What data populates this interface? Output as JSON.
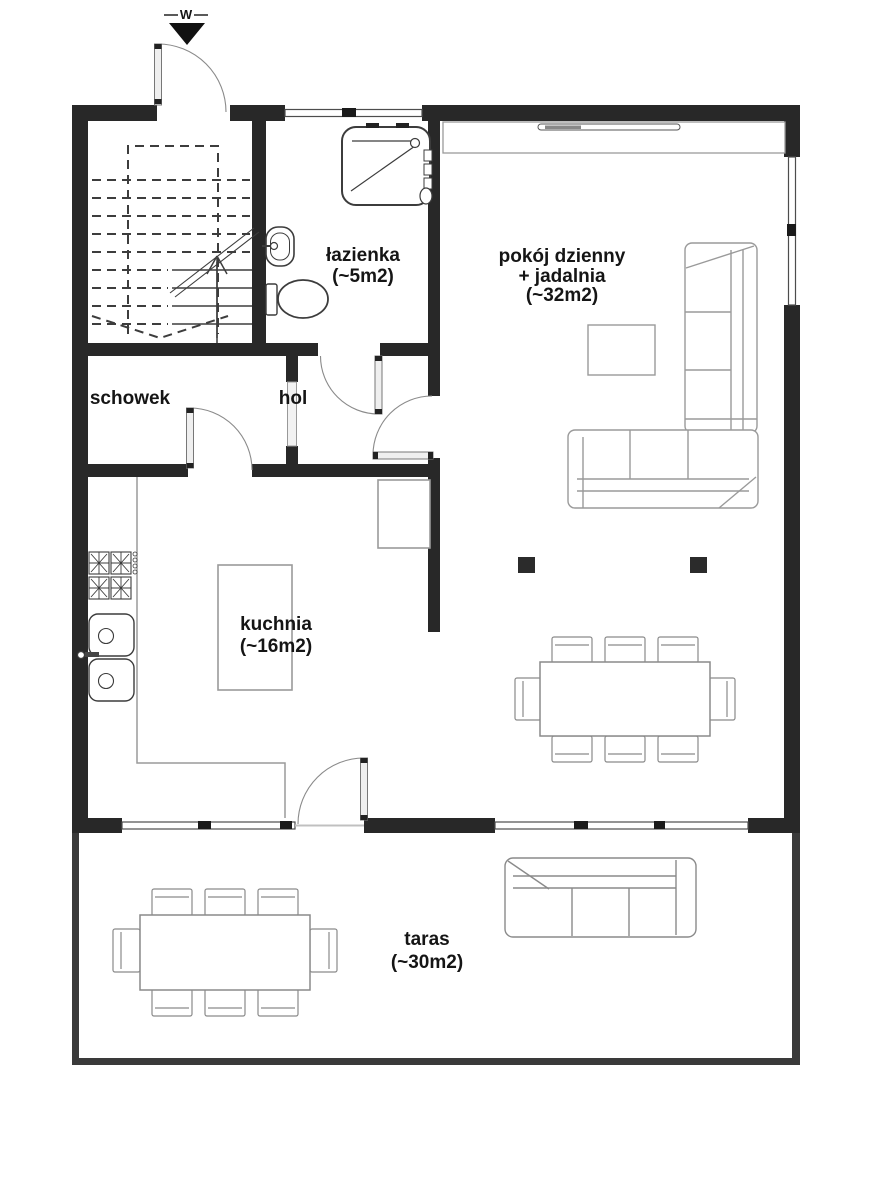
{
  "plan": {
    "entrance": {
      "marker": "W"
    },
    "rooms": {
      "bathroom": {
        "line1": "łazienka",
        "line2": "(~5m2)"
      },
      "living": {
        "line1": "pokój dzienny",
        "line2": "+ jadalnia",
        "line3": "(~32m2)"
      },
      "storage": {
        "line1": "schowek"
      },
      "hall": {
        "line1": "hol"
      },
      "kitchen": {
        "line1": "kuchnia",
        "line2": "(~16m2)"
      },
      "terrace": {
        "line1": "taras",
        "line2": "(~30m2)"
      }
    },
    "colors": {
      "wall": "#282828",
      "terrace_border": "#3a3a3a",
      "furniture_stroke": "#9a9a9a",
      "fixture_stroke": "#3c3c3c",
      "text": "#151515"
    }
  }
}
